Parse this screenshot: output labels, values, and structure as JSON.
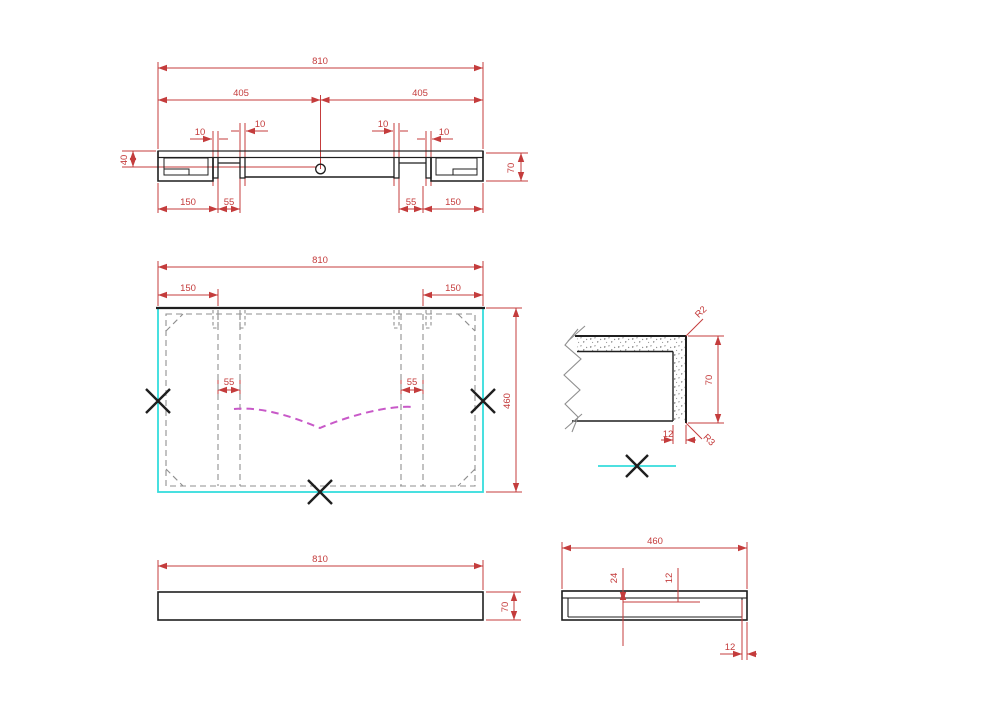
{
  "drawing": {
    "type": "technical-drawing",
    "palette": {
      "dimension_red": "#c43c3c",
      "outline_black": "#1f1f1f",
      "hidden_gray": "#8f8f8f",
      "edge_cyan": "#35dcdc",
      "slope_magenta": "#c859c8"
    },
    "section_view": {
      "overall_width": "810",
      "half_span_left": "405",
      "half_span_right": "405",
      "slot_width_a": "10",
      "slot_width_b": "10",
      "slot_width_c": "10",
      "slot_width_d": "10",
      "rim_height": "40",
      "total_height": "70",
      "bottom_offset_left": "150",
      "bottom_gap_left": "55",
      "bottom_gap_right": "55",
      "bottom_offset_right": "150"
    },
    "plan_view": {
      "overall_width": "810",
      "slot_offset_left": "150",
      "slot_offset_right": "150",
      "rib_spacing_left": "55",
      "rib_spacing_right": "55",
      "overall_depth": "460"
    },
    "corner_detail": {
      "top_radius": "R2",
      "height": "70",
      "wall_thickness": "12",
      "bottom_radius": "R3"
    },
    "front_view": {
      "overall_width": "810",
      "height": "70"
    },
    "side_view": {
      "overall_width": "460",
      "recess_depth": "24",
      "ledge_depth": "12",
      "wall_thickness": "12"
    }
  }
}
